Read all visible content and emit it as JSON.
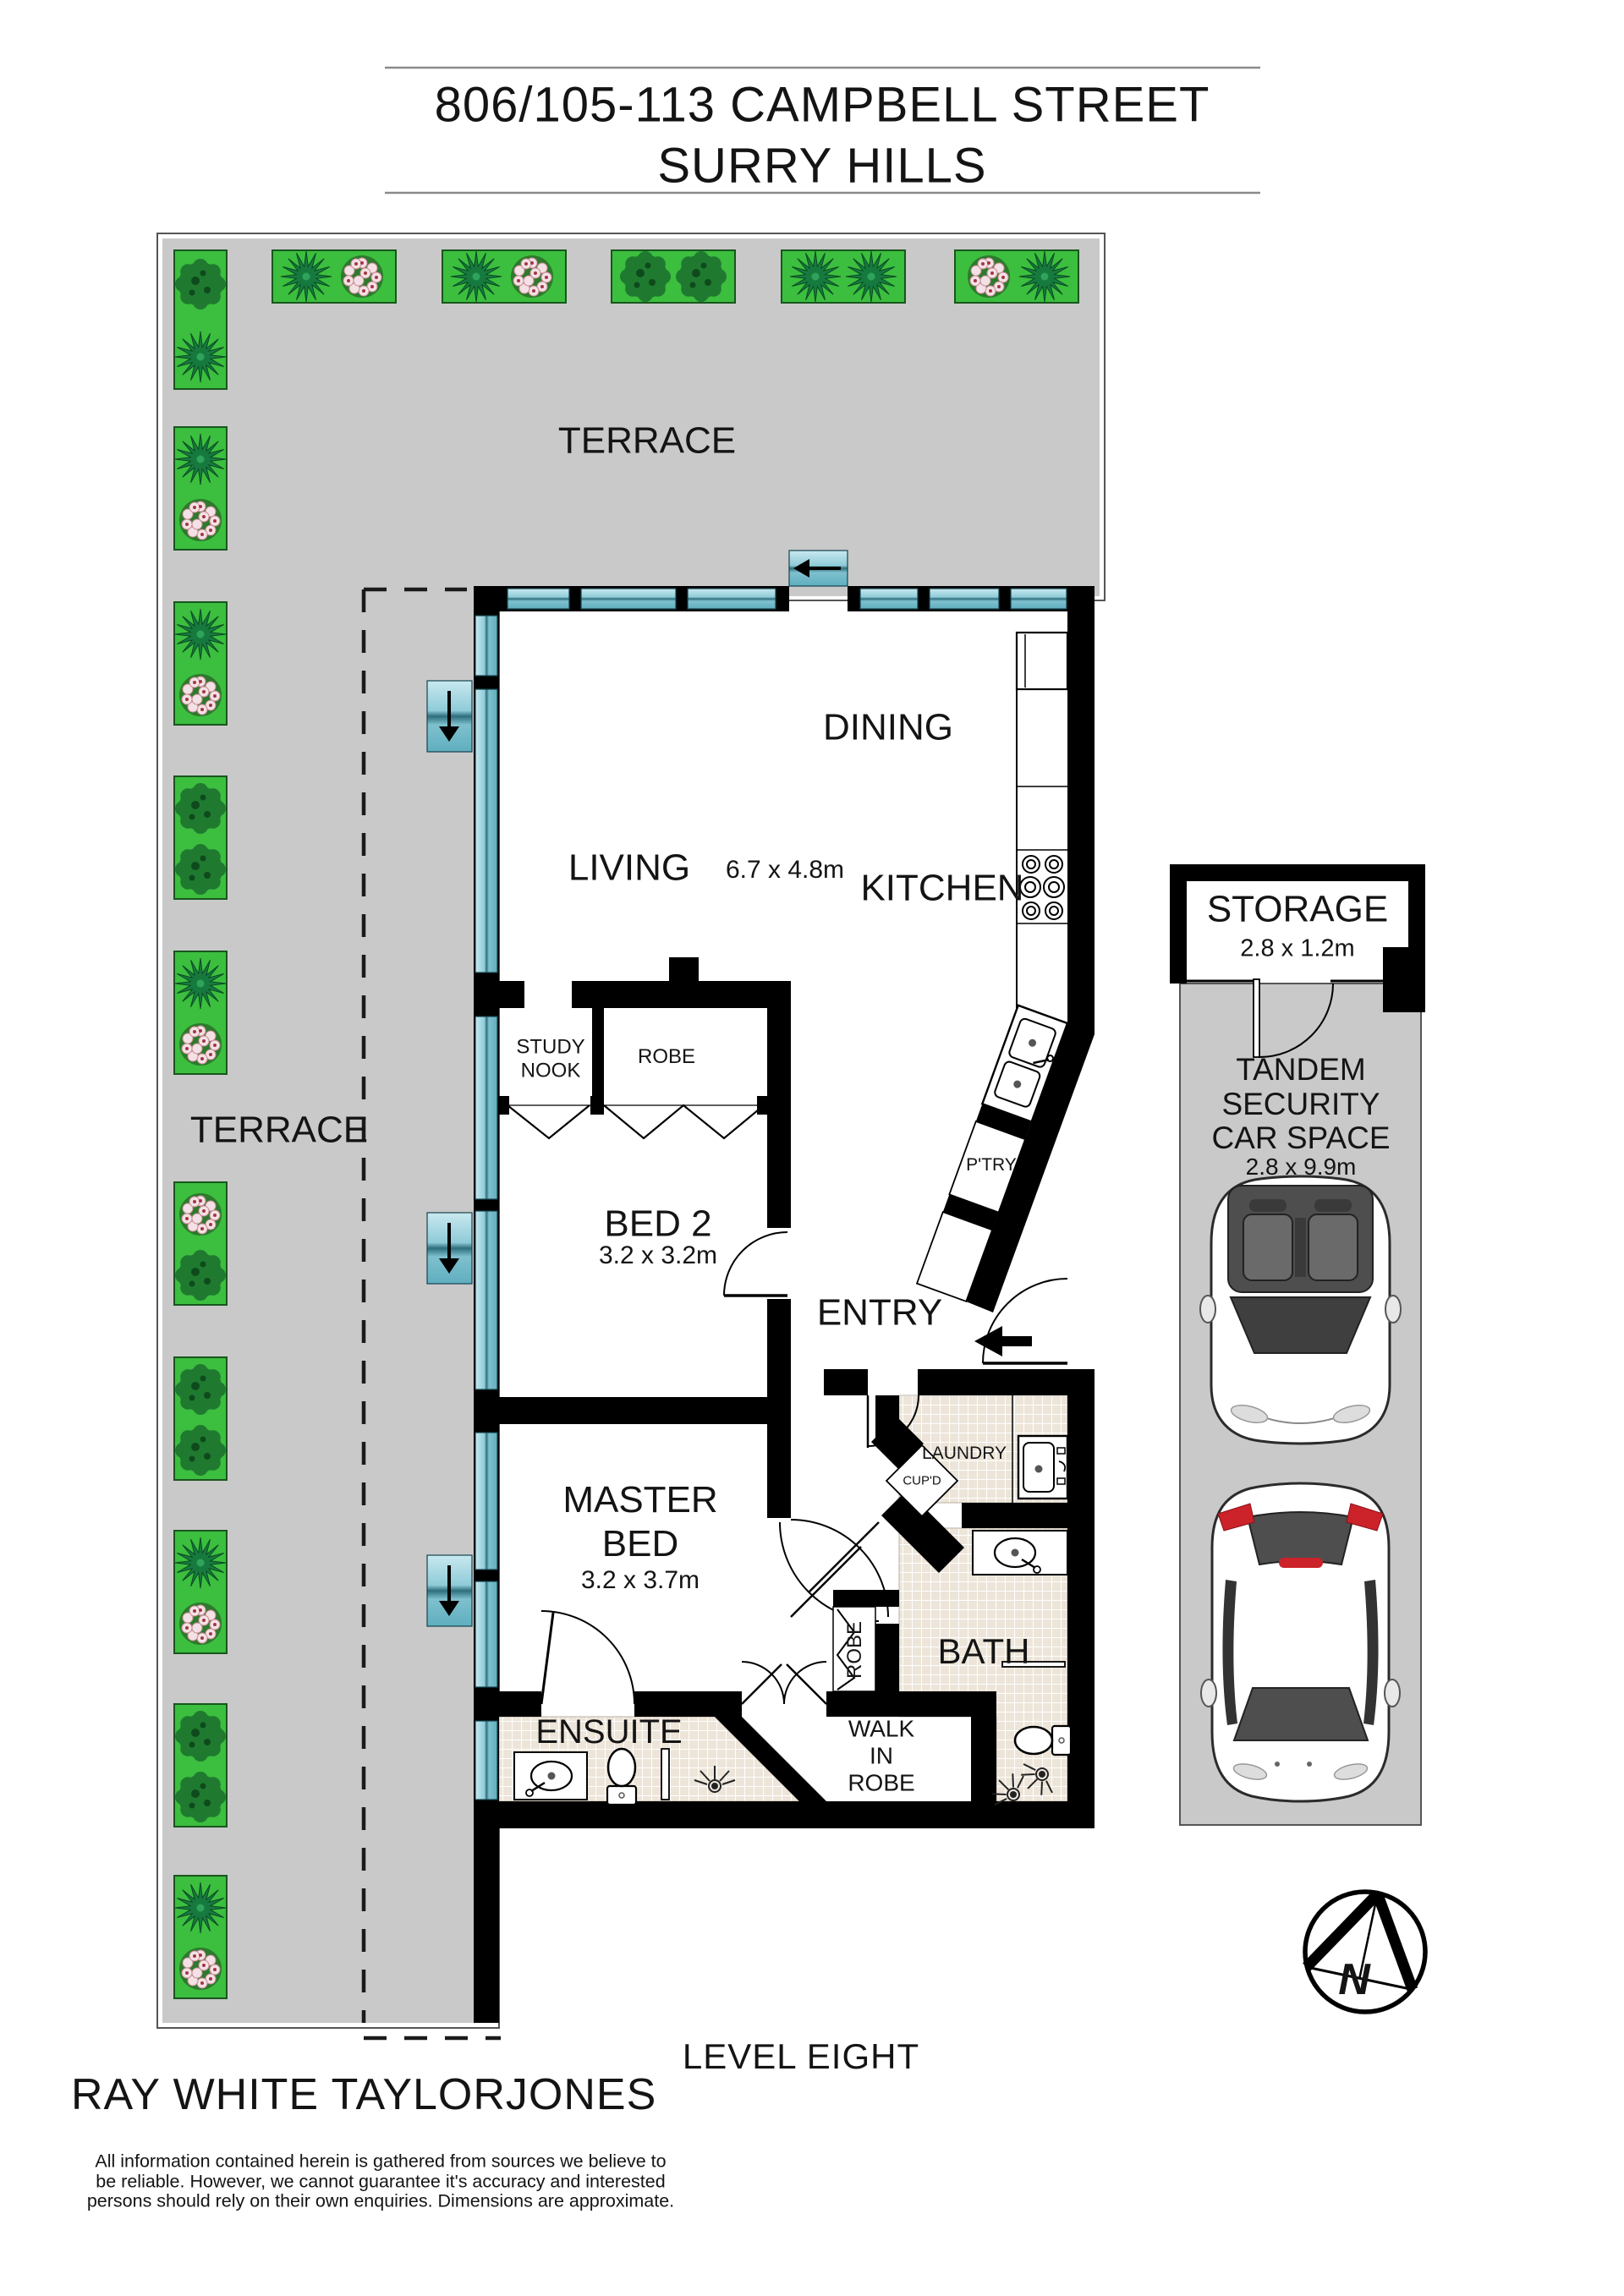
{
  "colors": {
    "wall": "#000000",
    "terrace_gray": "#C9C9C9",
    "window_teal": "#7FC4D2",
    "planter_green": "#3CBE3E",
    "bush_green": "#1F7A30",
    "tile_beige": "#EDE5D9",
    "tail_light_red": "#CC2229"
  },
  "title": {
    "address": "806/105-113 CAMPBELL STREET",
    "suburb": "SURRY HILLS"
  },
  "outdoor": {
    "terrace_top": "TERRACE",
    "terrace_left": "TERRACE"
  },
  "rooms": {
    "dining": "DINING",
    "living": "LIVING",
    "living_dims": "6.7 x 4.8m",
    "kitchen": "KITCHEN",
    "pantry": "P'TRY",
    "study_nook": "STUDY NOOK",
    "robe_bed2": "ROBE",
    "bed2": "BED 2",
    "bed2_dims": "3.2 x 3.2m",
    "entry": "ENTRY",
    "master_bed": "MASTER BED",
    "master_dims": "3.2 x 3.7m",
    "laundry": "LAUNDRY",
    "cupboard": "CUP'D",
    "robe_hall": "ROBE",
    "bath": "BATH",
    "ensuite": "ENSUITE",
    "walk_in_robe": "WALK IN ROBE"
  },
  "parking": {
    "storage": "STORAGE",
    "storage_dims": "2.8 x 1.2m",
    "car_space": "TANDEM SECURITY CAR SPACE",
    "car_space_dims": "2.8 x 9.9m"
  },
  "compass": {
    "north": "N"
  },
  "footer": {
    "level": "LEVEL EIGHT",
    "agency": "RAY WHITE TAYLORJONES",
    "disclaimer": "All information contained herein is gathered from sources we believe to be reliable. However, we cannot guarantee it's accuracy and interested persons should rely on their own enquiries. Dimensions are approximate."
  }
}
